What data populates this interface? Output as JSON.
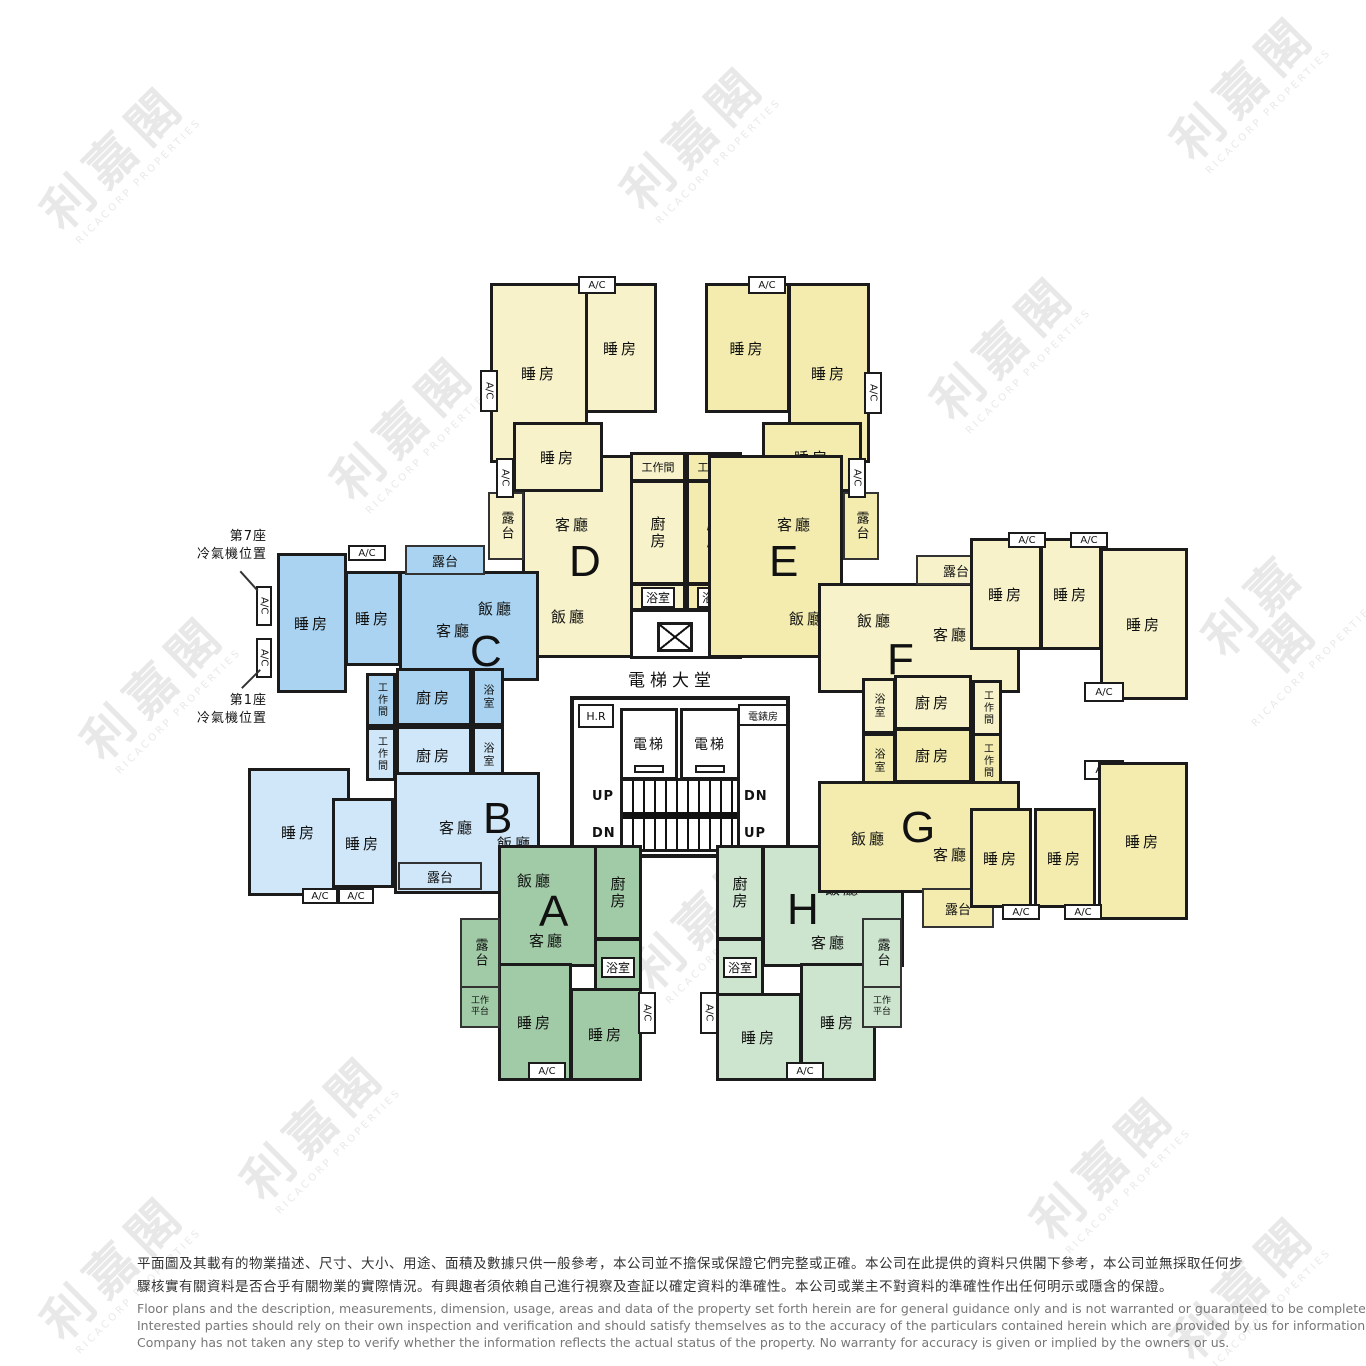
{
  "brand": {
    "name_zh": "利嘉閣",
    "name_en": "RICACORP PROPERTIES"
  },
  "units": [
    {
      "letter": "A"
    },
    {
      "letter": "B"
    },
    {
      "letter": "C"
    },
    {
      "letter": "D"
    },
    {
      "letter": "E"
    },
    {
      "letter": "F"
    },
    {
      "letter": "G"
    },
    {
      "letter": "H"
    }
  ],
  "rooms": {
    "bedroom": "睡房",
    "living_room": "客廳",
    "dining_room": "飯廳",
    "kitchen": "廚房",
    "bathroom": "浴室",
    "balcony": "露台",
    "utility_room": "工作間",
    "work_platform": "工作平台",
    "ac": "A/C"
  },
  "lobby": {
    "title": "電梯大堂",
    "lift": "電梯",
    "hose_reel": "H.R",
    "meter_room": "電錶房",
    "up": "UP",
    "down": "DN"
  },
  "annotations": {
    "tower7_line1": "第7座",
    "tower7_line2": "冷氣機位置",
    "tower1_line1": "第1座",
    "tower1_line2": "冷氣機位置"
  },
  "colors": {
    "unit_d_f": "#f7f2c9",
    "unit_e_g": "#f3ecae",
    "unit_c": "#a9d3f0",
    "unit_b": "#cfe7f8",
    "unit_a": "#a0cba6",
    "unit_h": "#cde4cf",
    "wall": "#1b1b1b"
  },
  "disclaimer": {
    "zh_line1": "平面圖及其載有的物業描述、尺寸、大小、用途、面積及數據只供一般參考，本公司並不擔保或保證它們完整或正確。本公司在此提供的資料只供閣下參考，本公司並無採取任何步",
    "zh_line2": "驟核實有關資料是否合乎有關物業的實際情況。有興趣者須依賴自己進行視察及查証以確定資料的準確性。本公司或業主不對資料的準確性作出任何明示或隱含的保證。",
    "en_line1": "Floor plans and the description, measurements, dimension, usage, areas and data of the property set forth herein are for general guidance only and is not warranted or guaranteed to be complete or correct.",
    "en_line2": "Interested parties should rely on their own inspection and verification and should satisfy themselves as to the accuracy of the particulars contained herein which are provided by us for information only.  Our",
    "en_line3": "Company has not taken any step to verify whether the information reflects the actual status of the property.  No warranty for accuracy is given or implied by the owners or us."
  }
}
